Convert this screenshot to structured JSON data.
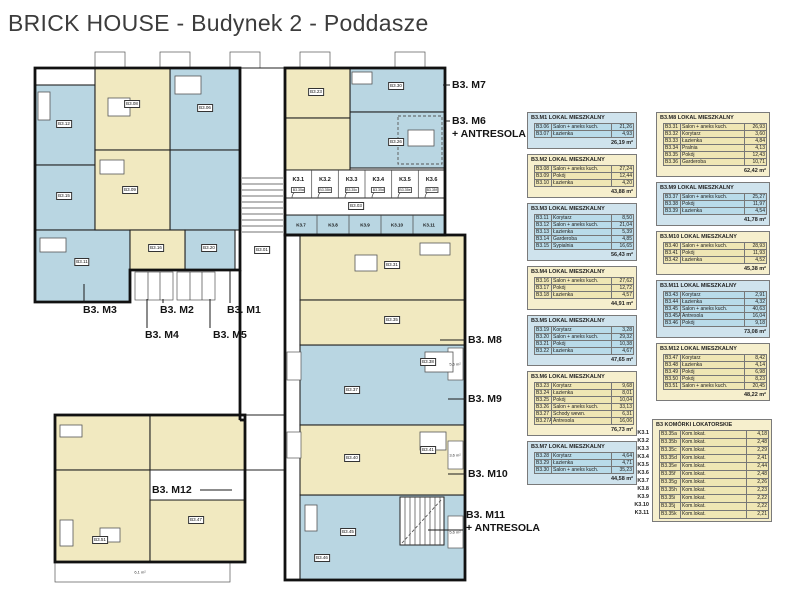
{
  "title": "BRICK HOUSE - Budynek 2 - Poddasze",
  "colors": {
    "room_blue": "#b9d6e2",
    "room_cream": "#f1e9c0",
    "panel_blue": "#cfe3ed",
    "panel_cream": "#f6efcd",
    "cell_blue": "#b9dbe9",
    "cell_cream": "#efe6b4",
    "wall": "#111111",
    "title_text": "#3c3c3c"
  },
  "plan": {
    "unit_labels": [
      {
        "id": "m7",
        "lines": [
          "B3. M7"
        ],
        "x": 452,
        "y": 79,
        "leader": [
          443,
          85,
          450,
          85
        ]
      },
      {
        "id": "m6",
        "lines": [
          "B3. M6",
          "+ ANTRESOLA"
        ],
        "x": 452,
        "y": 115,
        "leader": [
          446,
          121,
          450,
          121
        ]
      },
      {
        "id": "m3",
        "lines": [
          "B3. M3"
        ],
        "x": 83,
        "y": 304,
        "leader": [
          84,
          284,
          84,
          303
        ]
      },
      {
        "id": "m2",
        "lines": [
          "B3. M2"
        ],
        "x": 160,
        "y": 304,
        "leader": [
          163,
          299,
          163,
          303
        ]
      },
      {
        "id": "m1",
        "lines": [
          "B3. M1"
        ],
        "x": 227,
        "y": 304,
        "leader": [
          230,
          271,
          230,
          303
        ]
      },
      {
        "id": "m4",
        "lines": [
          "B3. M4"
        ],
        "x": 145,
        "y": 329,
        "leader": [
          147,
          299,
          147,
          328
        ]
      },
      {
        "id": "m5",
        "lines": [
          "B3. M5"
        ],
        "x": 213,
        "y": 329,
        "leader": [
          210,
          299,
          210,
          328
        ]
      },
      {
        "id": "m8",
        "lines": [
          "B3. M8"
        ],
        "x": 468,
        "y": 334,
        "leader": [
          440,
          340,
          466,
          340
        ]
      },
      {
        "id": "m9",
        "lines": [
          "B3. M9"
        ],
        "x": 468,
        "y": 393,
        "leader": [
          448,
          399,
          466,
          399
        ]
      },
      {
        "id": "m10",
        "lines": [
          "B3. M10"
        ],
        "x": 468,
        "y": 468,
        "leader": [
          448,
          474,
          466,
          474
        ]
      },
      {
        "id": "m11",
        "lines": [
          "B3. M11",
          "+ ANTRESOLA"
        ],
        "x": 466,
        "y": 509,
        "leader": [
          428,
          530,
          463,
          530
        ]
      },
      {
        "id": "m12",
        "lines": [
          "B3. M12"
        ],
        "x": 152,
        "y": 484,
        "leader": [
          200,
          490,
          232,
          490
        ]
      }
    ],
    "storage_k1": [
      "K3.1",
      "K3.2",
      "K3.3",
      "K3.4",
      "K3.5",
      "K3.6"
    ],
    "storage_k1_codes": [
      "B3.35a",
      "B3.35b",
      "B3.35c",
      "B3.35d",
      "B3.35e",
      "B3.35f"
    ],
    "storage_k2": [
      "K3.7",
      "K3.8",
      "K3.9",
      "K3.10",
      "K3.11"
    ],
    "room_chips": [
      {
        "code": "B3.06",
        "x": 205,
        "y": 108
      },
      {
        "code": "B3.08",
        "x": 132,
        "y": 104
      },
      {
        "code": "B3.09",
        "x": 130,
        "y": 190
      },
      {
        "code": "B3.12",
        "x": 64,
        "y": 124
      },
      {
        "code": "B3.15",
        "x": 64,
        "y": 196
      },
      {
        "code": "B3.11",
        "x": 82,
        "y": 262
      },
      {
        "code": "B3.16",
        "x": 156,
        "y": 248
      },
      {
        "code": "B3.20",
        "x": 209,
        "y": 248
      },
      {
        "code": "B3.23",
        "x": 316,
        "y": 92
      },
      {
        "code": "B3.30",
        "x": 396,
        "y": 86
      },
      {
        "code": "B3.26",
        "x": 396,
        "y": 142
      },
      {
        "code": "B3.31",
        "x": 392,
        "y": 265
      },
      {
        "code": "B3.35",
        "x": 392,
        "y": 320
      },
      {
        "code": "B3.37",
        "x": 352,
        "y": 390
      },
      {
        "code": "B3.38",
        "x": 428,
        "y": 362
      },
      {
        "code": "B3.40",
        "x": 352,
        "y": 458
      },
      {
        "code": "B3.41",
        "x": 428,
        "y": 450
      },
      {
        "code": "B3.45",
        "x": 348,
        "y": 532
      },
      {
        "code": "B3.46",
        "x": 322,
        "y": 558
      },
      {
        "code": "B3.47",
        "x": 196,
        "y": 520
      },
      {
        "code": "B3.51",
        "x": 100,
        "y": 540
      },
      {
        "code": "B3.01",
        "x": 262,
        "y": 250
      },
      {
        "code": "B3.03",
        "x": 356,
        "y": 206
      }
    ],
    "balcony_labels": [
      {
        "text": "6,1 m²",
        "x": 140,
        "y": 572
      },
      {
        "text": "5,6 m²",
        "x": 455,
        "y": 364
      },
      {
        "text": "3,6 m²",
        "x": 455,
        "y": 455
      },
      {
        "text": "5,6 m²",
        "x": 455,
        "y": 532
      }
    ]
  },
  "apartment_tables": [
    {
      "id": "B3M1",
      "column": "left",
      "color": "blue",
      "title": "B3.M1 LOKAL MIESZKALNY",
      "rows": [
        [
          "B3.06",
          "Salon + aneks kuch.",
          "21,26"
        ],
        [
          "B3.07",
          "Łazienka",
          "4,93"
        ]
      ],
      "total": "26,19 m²"
    },
    {
      "id": "B3M2",
      "column": "left",
      "color": "cream",
      "title": "B3.M2 LOKAL MIESZKALNY",
      "rows": [
        [
          "B3.08",
          "Salon + aneks kuch.",
          "27,24"
        ],
        [
          "B3.09",
          "Pokój",
          "12,44"
        ],
        [
          "B3.10",
          "Łazienka",
          "4,20"
        ]
      ],
      "total": "43,88 m²"
    },
    {
      "id": "B3M3",
      "column": "left",
      "color": "blue",
      "title": "B3.M3 LOKAL MIESZKALNY",
      "rows": [
        [
          "B3.11",
          "Korytarz",
          "8,50"
        ],
        [
          "B3.12",
          "Salon + aneks kuch.",
          "21,04"
        ],
        [
          "B3.13",
          "Łazienka",
          "5,39"
        ],
        [
          "B3.14",
          "Garderoba",
          "4,85"
        ],
        [
          "B3.15",
          "Sypialnia",
          "16,65"
        ]
      ],
      "total": "56,43 m²"
    },
    {
      "id": "B3M4",
      "column": "left",
      "color": "cream",
      "title": "B3.M4 LOKAL MIESZKALNY",
      "rows": [
        [
          "B3.16",
          "Salon + aneks kuch.",
          "27,62"
        ],
        [
          "B3.17",
          "Pokój",
          "12,72"
        ],
        [
          "B3.18",
          "Łazienka",
          "4,57"
        ]
      ],
      "total": "44,91 m²"
    },
    {
      "id": "B3M5",
      "column": "left",
      "color": "blue",
      "title": "B3.M5 LOKAL MIESZKALNY",
      "rows": [
        [
          "B3.19",
          "Korytarz",
          "3,28"
        ],
        [
          "B3.20",
          "Salon + aneks kuch.",
          "29,32"
        ],
        [
          "B3.21",
          "Pokój",
          "10,38"
        ],
        [
          "B3.22",
          "Łazienka",
          "4,67"
        ]
      ],
      "total": "47,65 m²"
    },
    {
      "id": "B3M6",
      "column": "left",
      "color": "cream",
      "title": "B3.M6 LOKAL MIESZKALNY",
      "rows": [
        [
          "B3.23",
          "Korytarz",
          "9,68"
        ],
        [
          "B3.24",
          "Łazienka",
          "8,01"
        ],
        [
          "B3.25",
          "Pokój",
          "10,04"
        ],
        [
          "B3.26",
          "Salon + aneks kuch.",
          "33,13"
        ],
        [
          "B3.27",
          "Schody wewn.",
          "6,31"
        ],
        [
          "B3.27A",
          "Antresola",
          "16,06"
        ]
      ],
      "total": "76,73 m²"
    },
    {
      "id": "B3M7",
      "column": "left",
      "color": "blue",
      "title": "B3.M7 LOKAL MIESZKALNY",
      "rows": [
        [
          "B3.28",
          "Korytarz",
          "4,64"
        ],
        [
          "B3.29",
          "Łazienka",
          "4,71"
        ],
        [
          "B3.30",
          "Salon + aneks kuch.",
          "35,23"
        ]
      ],
      "total": "44,58 m²"
    },
    {
      "id": "B3M8",
      "column": "right",
      "color": "cream",
      "title": "B3.M8 LOKAL MIESZKALNY",
      "rows": [
        [
          "B3.31",
          "Salon + aneks kuch.",
          "26,93"
        ],
        [
          "B3.32",
          "Korytarz",
          "3,60"
        ],
        [
          "B3.33",
          "Łazienka",
          "4,84"
        ],
        [
          "B3.34",
          "Pralnia",
          "4,13"
        ],
        [
          "B3.35",
          "Pokój",
          "12,43"
        ],
        [
          "B3.36",
          "Garderoba",
          "10,71"
        ]
      ],
      "total": "62,42 m²"
    },
    {
      "id": "B3M9",
      "column": "right",
      "color": "blue",
      "title": "B3.M9 LOKAL MIESZKALNY",
      "rows": [
        [
          "B3.37",
          "Salon + aneks kuch.",
          "25,27"
        ],
        [
          "B3.38",
          "Pokój",
          "11,97"
        ],
        [
          "B3.39",
          "Łazienka",
          "4,54"
        ]
      ],
      "total": "41,78 m²"
    },
    {
      "id": "B3M10",
      "column": "right",
      "color": "cream",
      "title": "B3.M10 LOKAL MIESZKALNY",
      "rows": [
        [
          "B3.40",
          "Salon + aneks kuch.",
          "28,93"
        ],
        [
          "B3.41",
          "Pokój",
          "11,93"
        ],
        [
          "B3.42",
          "Łazienka",
          "4,52"
        ]
      ],
      "total": "45,38 m²"
    },
    {
      "id": "B3M11",
      "column": "right",
      "color": "blue",
      "title": "B3.M11 LOKAL MIESZKALNY",
      "rows": [
        [
          "B3.43",
          "Korytarz",
          "2,91"
        ],
        [
          "B3.44",
          "Łazienka",
          "4,32"
        ],
        [
          "B3.45",
          "Salon + aneks kuch.",
          "40,63"
        ],
        [
          "B3.45A",
          "Antresola",
          "16,04"
        ],
        [
          "B3.46",
          "Pokój",
          "9,18"
        ]
      ],
      "total": "73,08 m²"
    },
    {
      "id": "B3M12",
      "column": "right",
      "color": "cream",
      "title": "B3.M12 LOKAL MIESZKALNY",
      "rows": [
        [
          "B3.47",
          "Korytarz",
          "8,42"
        ],
        [
          "B3.48",
          "Łazienka",
          "4,14"
        ],
        [
          "B3.49",
          "Pokój",
          "6,98"
        ],
        [
          "B3.50",
          "Pokój",
          "8,23"
        ],
        [
          "B3.51",
          "Salon + aneks kuch.",
          "20,45"
        ]
      ],
      "total": "48,22 m²"
    }
  ],
  "storage_table": {
    "title": "B3 KOMÓRKI LOKATORSKIE",
    "color": "cream",
    "rows": [
      [
        "K3.1",
        "B3.35a",
        "Kom.lokat.",
        "4,18"
      ],
      [
        "K3.2",
        "B3.35b",
        "Kom.lokat.",
        "2,48"
      ],
      [
        "K3.3",
        "B3.35c",
        "Kom.lokat.",
        "2,29"
      ],
      [
        "K3.4",
        "B3.35d",
        "Kom.lokat.",
        "2,41"
      ],
      [
        "K3.5",
        "B3.35e",
        "Kom.lokat.",
        "2,44"
      ],
      [
        "K3.6",
        "B3.35f",
        "Kom.lokat.",
        "2,48"
      ],
      [
        "K3.7",
        "B3.35g",
        "Kom.lokat.",
        "2,26"
      ],
      [
        "K3.8",
        "B3.35h",
        "Kom.lokat.",
        "2,23"
      ],
      [
        "K3.9",
        "B3.35i",
        "Kom.lokat.",
        "2,22"
      ],
      [
        "K3.10",
        "B3.35j",
        "Kom.lokat.",
        "2,22"
      ],
      [
        "K3.11",
        "B3.35k",
        "Kom.lokat.",
        "2,21"
      ]
    ]
  }
}
